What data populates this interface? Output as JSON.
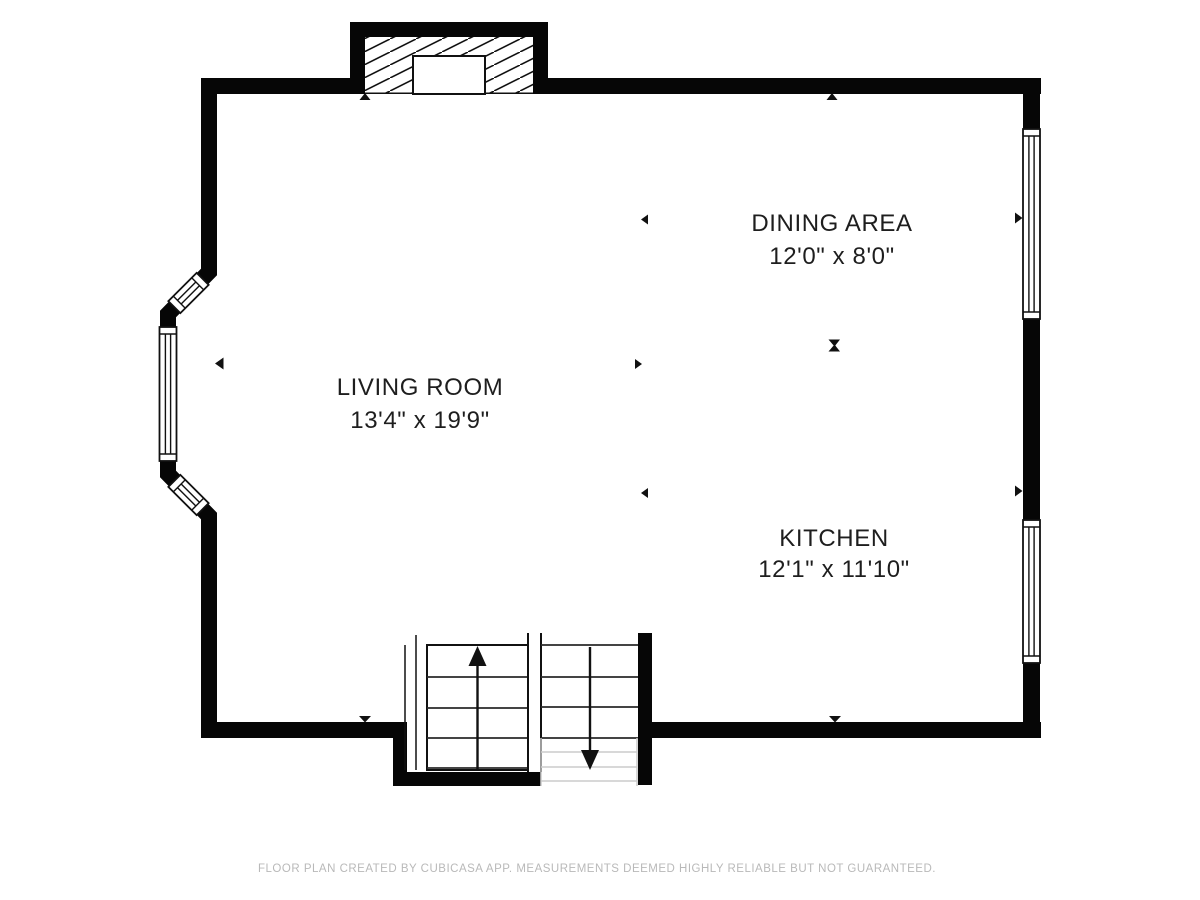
{
  "plan": {
    "title": "First floor plan",
    "colors": {
      "wall": "#060606",
      "background": "#ffffff",
      "label_text": "#1e1e1e",
      "faint_stairs": "#cbcbcb",
      "footer_text": "#b9b9b9"
    },
    "rooms": [
      {
        "name": "LIVING ROOM",
        "dimensions": "13'4\" x 19'9\""
      },
      {
        "name": "DINING AREA",
        "dimensions": "12'0\" x 8'0\""
      },
      {
        "name": "KITCHEN",
        "dimensions": "12'1\" x 11'10\""
      }
    ],
    "features": {
      "fireplace": "fireplace with hatched chimney and firebox",
      "bay_window": "3-panel bay window on left wall",
      "right_windows": 2,
      "staircase": "double flight: up arrow and down arrow"
    }
  },
  "footer": {
    "text": "FLOOR PLAN CREATED BY CUBICASA APP. MEASUREMENTS DEEMED HIGHLY RELIABLE BUT NOT GUARANTEED."
  }
}
